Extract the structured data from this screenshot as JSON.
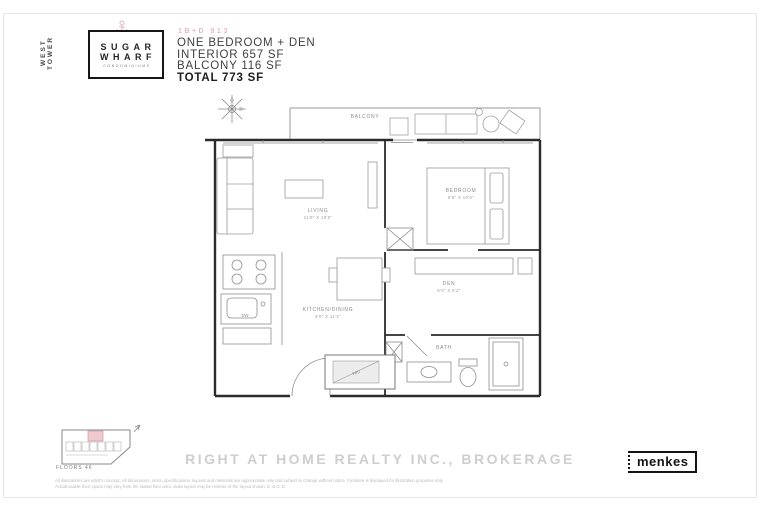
{
  "header": {
    "tower_label": "WEST TOWER",
    "logo_line1": "SUGAR",
    "logo_line2": "WHARF",
    "logo_line3": "CONDOMINIUMS",
    "plan_code": "1B+D 913",
    "unit_type": "ONE BEDROOM + DEN",
    "interior_area": "INTERIOR 657 SF",
    "balcony_area": "BALCONY 116 SF",
    "total_area": "TOTAL 773 SF"
  },
  "plan": {
    "balcony_label": "BALCONY",
    "living_name": "LIVING",
    "living_dims": "11'6\" X 10'6\"",
    "bedroom_name": "BEDROOM",
    "bedroom_dims": "9'6\" X 10'6\"",
    "den_name": "DEN",
    "den_dims": "6'0\" X 8'2\"",
    "kitchen_name": "KITCHEN/DINING",
    "kitchen_dims": "9'0\" X 11'3\"",
    "bath_name": "BATH",
    "wd_label": "W/D",
    "dw_label": "DW"
  },
  "keyplan": {
    "floors_label": "FLOORS 46"
  },
  "footer": {
    "watermark": "RIGHT AT HOME REALTY INC., BROKERAGE",
    "builder_logo": "menkes",
    "disclaimer_line1": "All illustrations are artist's concept. All dimensions, sizes, specifications, layouts and materials are approximate only and subject to change without notice. Furniture is displayed for illustration purposes only.",
    "disclaimer_line2": "Actual usable floor space may vary from the stated floor area. Suite layout may be reverse of the layout shown. E. & O. E."
  },
  "colors": {
    "accent_pink": "#e8c0c6",
    "wall_line": "#2b2b2b",
    "furniture_line": "#9a9a9a",
    "muted_text": "#8c8c8c"
  }
}
